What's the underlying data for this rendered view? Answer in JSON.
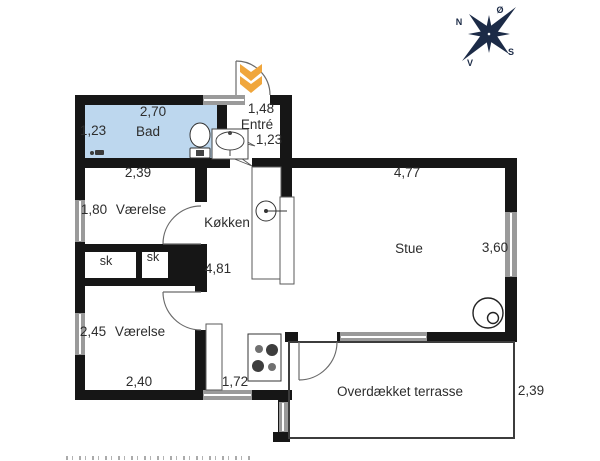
{
  "colors": {
    "wall": "#161616",
    "bath": "#bdd7ee",
    "arrow": "#f0a63c",
    "compass": "#1c2b47",
    "text": "#2d2d2d"
  },
  "compass": {
    "north": "N",
    "east": "Ø",
    "south": "S",
    "west": "V"
  },
  "labels": {
    "bad": {
      "name": "Bad",
      "top": "2,70",
      "left": "1,23",
      "below": "2,39"
    },
    "entre": {
      "name": "Entré",
      "top": "1,48",
      "right": "1,23"
    },
    "vaerelse_1": {
      "name": "Værelse",
      "left": "1,80"
    },
    "koekken": {
      "name": "Køkken",
      "length": "4,81"
    },
    "sk_1": "sk",
    "sk_2": "sk",
    "vaerelse_2": {
      "name": "Værelse",
      "left": "2,45",
      "bottom": "2,40"
    },
    "kitchen_south": "1,72",
    "stue": {
      "name": "Stue",
      "top": "4,77",
      "right": "3,60"
    },
    "terrasse": {
      "name": "Overdækket terrasse",
      "right": "2,39"
    }
  }
}
